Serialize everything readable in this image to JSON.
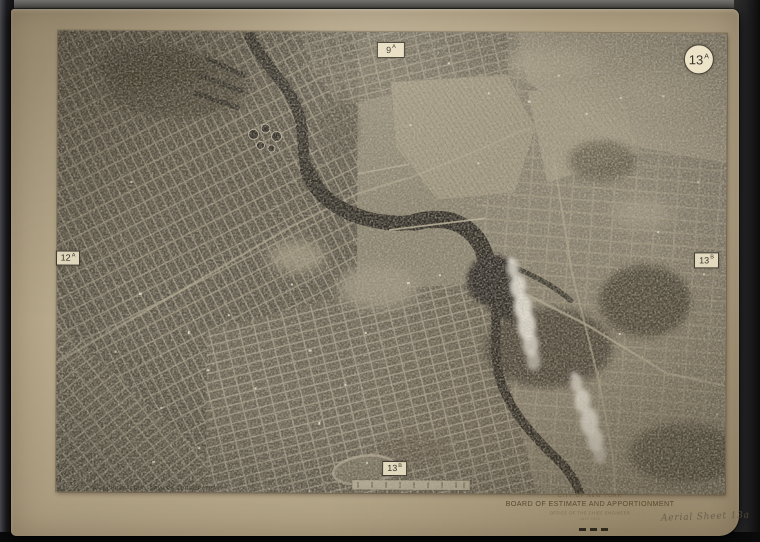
{
  "board": {
    "caption": {
      "city": "CITY OF NEW YORK",
      "title": "BOARD OF ESTIMATE AND APPORTIONMENT",
      "office": "OFFICE OF THE CHIEF ENGINEER",
      "date": "JULY 1924"
    },
    "credit": "FAIRCHILD AERIAL CAMERA CORPORATION",
    "annotation": "Aerial Sheet 13a"
  },
  "photo": {
    "plate_badge": {
      "number": "13",
      "letter": "A"
    },
    "edge_tags": {
      "top": {
        "number": "9",
        "letter": "A"
      },
      "left": {
        "number": "12",
        "letter": "A"
      },
      "right": {
        "number": "13",
        "letter": "B"
      },
      "bottom": {
        "number": "13",
        "letter": "B"
      }
    }
  },
  "colors": {
    "backdrop": "#1b1b1d",
    "board": "#b7a88b",
    "photo_base": "#8e8672",
    "river": "#2e2b24",
    "badge_bg": "#ece3c9",
    "smoke": "#f5f2e8",
    "caption_ink": "#57492f"
  }
}
